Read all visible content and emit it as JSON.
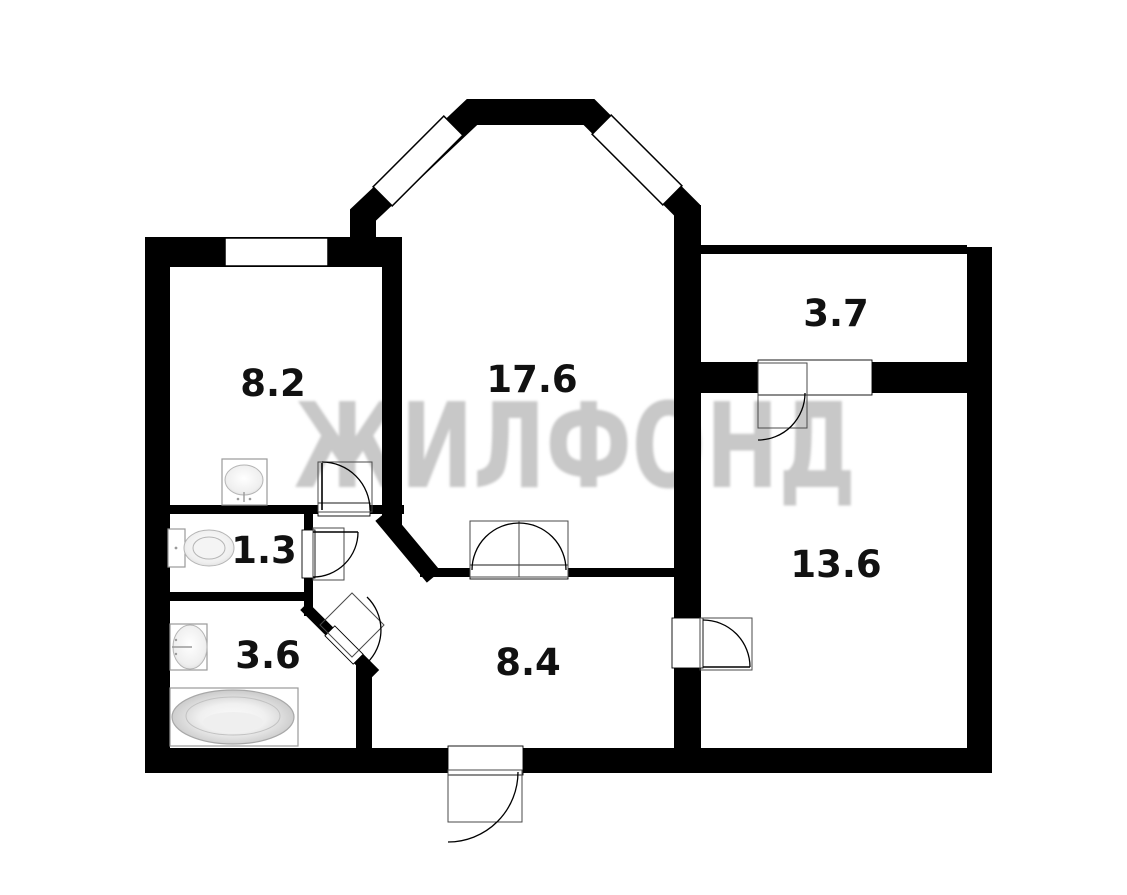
{
  "floorplan": {
    "watermark": "ЖИЛФОНД",
    "rooms": [
      {
        "name": "room-kitchen",
        "area": "8.2"
      },
      {
        "name": "room-living",
        "area": "17.6"
      },
      {
        "name": "room-storage",
        "area": "3.7"
      },
      {
        "name": "room-bedroom",
        "area": "13.6"
      },
      {
        "name": "room-wc",
        "area": "1.3"
      },
      {
        "name": "room-bathroom",
        "area": "3.6"
      },
      {
        "name": "room-hallway",
        "area": "8.4"
      }
    ],
    "windows": [
      "kitchen-window",
      "bay-window-left",
      "bay-window-right"
    ],
    "doors": [
      "kitchen-door",
      "wc-door",
      "bathroom-door",
      "living-double-door",
      "storage-door",
      "bedroom-door",
      "entrance-door"
    ],
    "fixtures": [
      "kitchen-sink",
      "toilet",
      "washbasin",
      "bathtub"
    ],
    "colors": {
      "wall": "#000000",
      "watermark": "#c8c8c8",
      "label": "#111111"
    }
  }
}
